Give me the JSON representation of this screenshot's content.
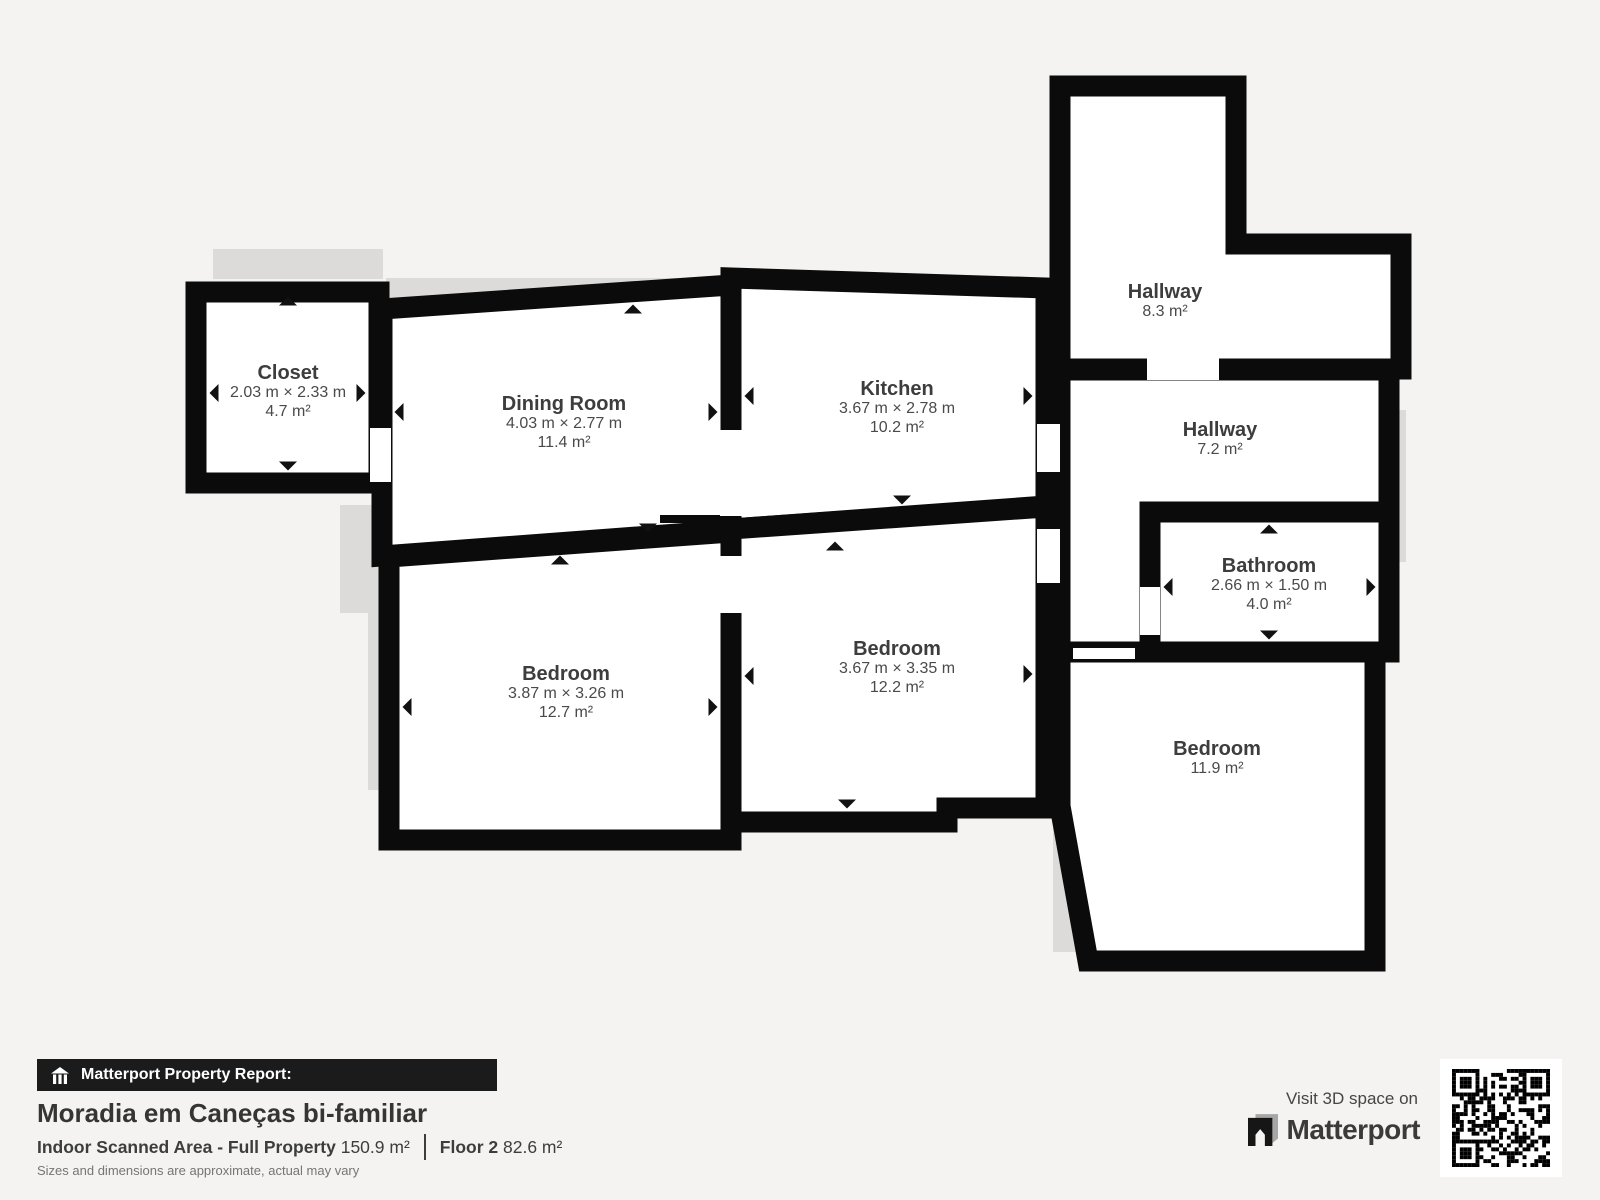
{
  "colors": {
    "background": "#f4f3f1",
    "wall": "#0b0b0b",
    "room_fill": "#ffffff",
    "shadow": "#dcdbd9",
    "room_name_text": "#3d3d3d",
    "room_dims_text": "#4a4a4a",
    "report_bar_bg": "#1b1b1b",
    "report_bar_text": "#ffffff",
    "title_text": "#353535",
    "disclaimer_text": "#757575"
  },
  "icons": {
    "report_bar": "house-icon",
    "brand": "matterport-m-icon",
    "qr": "qr-code"
  },
  "floorplan": {
    "rooms": [
      {
        "id": "closet",
        "name": "Closet",
        "dimensions": "2.03 m × 2.33 m",
        "area": "4.7 m²"
      },
      {
        "id": "dining-room",
        "name": "Dining Room",
        "dimensions": "4.03 m × 2.77 m",
        "area": "11.4 m²"
      },
      {
        "id": "kitchen",
        "name": "Kitchen",
        "dimensions": "3.67 m × 2.78 m",
        "area": "10.2 m²"
      },
      {
        "id": "hallway-upper",
        "name": "Hallway",
        "area": "8.3 m²"
      },
      {
        "id": "hallway-lower",
        "name": "Hallway",
        "area": "7.2 m²"
      },
      {
        "id": "bathroom",
        "name": "Bathroom",
        "dimensions": "2.66 m × 1.50 m",
        "area": "4.0 m²"
      },
      {
        "id": "bedroom-left",
        "name": "Bedroom",
        "dimensions": "3.87 m × 3.26 m",
        "area": "12.7 m²"
      },
      {
        "id": "bedroom-middle",
        "name": "Bedroom",
        "dimensions": "3.67 m × 3.35 m",
        "area": "12.2 m²"
      },
      {
        "id": "bedroom-right",
        "name": "Bedroom",
        "area": "11.9 m²"
      }
    ]
  },
  "footer": {
    "report_label": "Matterport Property Report:",
    "title": "Moradia em Caneças bi-familiar",
    "scanned_area_label": "Indoor Scanned Area - Full Property",
    "scanned_area_value": "150.9 m²",
    "floor_label": "Floor 2",
    "floor_value": "82.6 m²",
    "disclaimer": "Sizes and dimensions are approximate, actual may vary"
  },
  "cta": {
    "visit_label": "Visit 3D space on",
    "brand": "Matterport"
  }
}
